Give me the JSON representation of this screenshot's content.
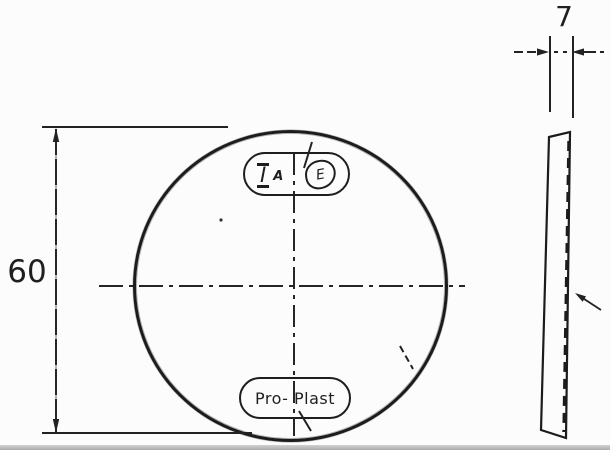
{
  "title": "Round reflector technical drawing",
  "front_view": {
    "diameter_label": "60",
    "certification_mark": {
      "i": "I",
      "a": "A",
      "e": "E"
    },
    "brand_label": "Pro- Plast"
  },
  "side_view": {
    "thickness_label": "7"
  },
  "colors": {
    "ink": "#1f1f1f",
    "paper": "#fcfcfc",
    "scan_edge": "#aaaaaa"
  }
}
